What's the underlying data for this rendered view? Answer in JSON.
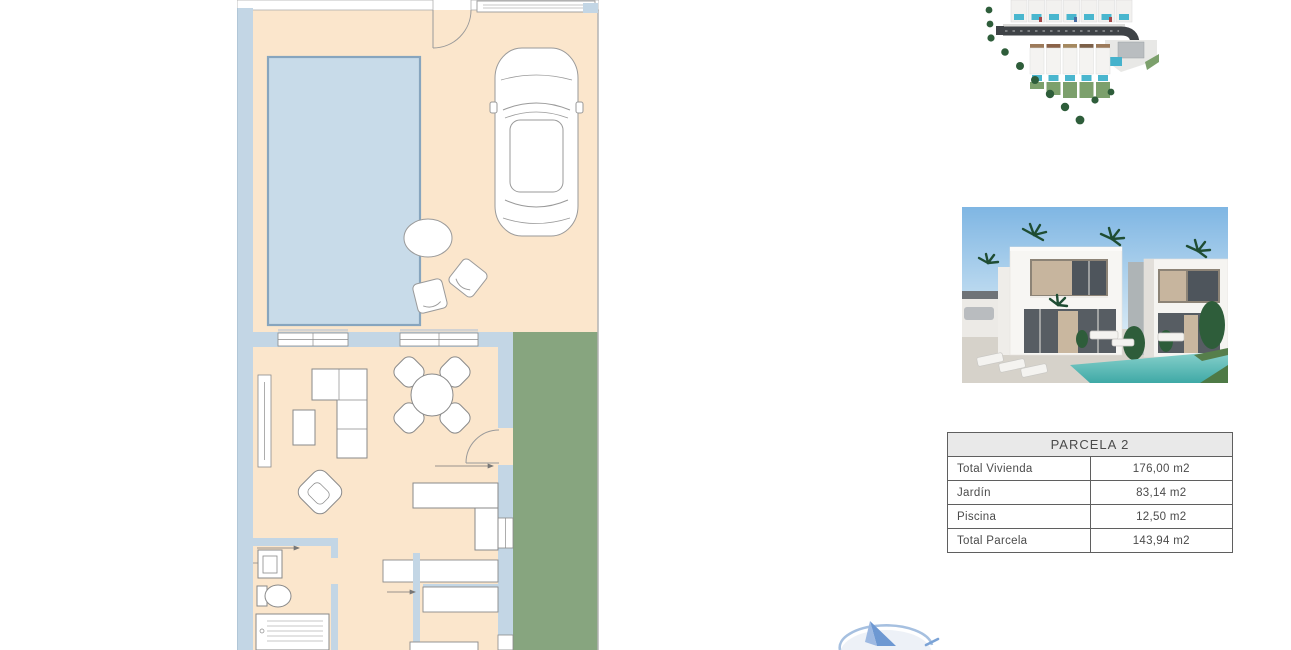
{
  "document": {
    "type": "property-brochure-page",
    "background": "#ffffff"
  },
  "floor_plan": {
    "name": "villa-plot-floor-plan",
    "colors": {
      "floor": "#fbe6cc",
      "walls": "#c3d6e5",
      "pool_fill": "#c8dbe9",
      "pool_border": "#87a5be",
      "garden": "#87a57f",
      "fixtures": "#ffffff",
      "outline": "#8a8a8a"
    },
    "features": [
      "swimming-pool",
      "parked-car",
      "terrace-round-table",
      "terrace-chairs",
      "entrance-door-swing",
      "driveway-gate",
      "living-room-sofa",
      "armchair",
      "side-table",
      "dining-table-with-chairs",
      "kitchen-counter",
      "staircase",
      "bathroom-sink",
      "toilet",
      "bathtub",
      "garden-strip",
      "windows"
    ]
  },
  "site_plan": {
    "name": "development-aerial-site-plan",
    "colors": {
      "road": "#3f4347",
      "pool": "#49b6ce",
      "garden": "#7ca06c",
      "tree": "#2e5d3a",
      "building": "#f2f1ef"
    }
  },
  "exterior_render": {
    "name": "villa-exterior-3d-render",
    "colors": {
      "sky": "#7fb6e3",
      "facade": "#f7f6f3",
      "glazing": "#545a60",
      "pool": "#52bdb8",
      "vegetation": "#2e5d3a",
      "paving": "#d6d2ca"
    }
  },
  "parcel_table": {
    "header": "PARCELA 2",
    "rows": [
      {
        "label": "Total Vivienda",
        "value": "176,00 m2"
      },
      {
        "label": "Jardín",
        "value": "83,14 m2"
      },
      {
        "label": "Piscina",
        "value": "12,50 m2"
      },
      {
        "label": "Total Parcela",
        "value": "143,94 m2"
      }
    ],
    "style": {
      "header_bg": "#e9e9e9",
      "border": "#5f5f5f",
      "text": "#4b4b4b"
    }
  },
  "logo": {
    "name": "sailboat-emblem-partially-visible",
    "colors": {
      "sail_dark": "#6d98d2",
      "sail_light": "#9db9e2",
      "arc": "#a6c0e0"
    }
  }
}
